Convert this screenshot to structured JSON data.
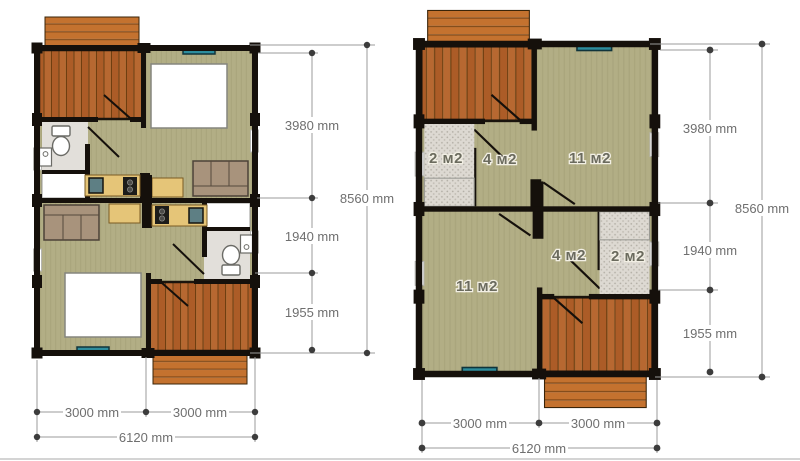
{
  "page": {
    "background": "#ffffff",
    "description": "Two duplex cabin floor plans with dimensions: left furnished, right with room areas"
  },
  "colors": {
    "wall": "#15100b",
    "deck_plank": "#ac5c27",
    "deck_plank_alt": "#b76831",
    "deck_gap": "#6f3e10",
    "stairs_plank": "#c4722f",
    "stairs_gap": "#7f4715",
    "floor_olive": "#b2ae85",
    "floor_grain": "#a8a47b",
    "window_teal": "#2d8d9d",
    "bath_floor": "#e2dfda",
    "bath_stipple": "#ddd9d2",
    "counter_tan": "#e5c578",
    "sofa": "#a8937c",
    "bed": "#ffffff",
    "dim_line": "#9b9b9b",
    "dim_dot": "#3c3c3c",
    "dim_text": "#6f6f6f",
    "room_label": "#6b6b5e"
  },
  "left_plan": {
    "dim_3980": "3980 mm",
    "dim_1940": "1940 mm",
    "dim_1955": "1955 mm",
    "dim_8560": "8560 mm",
    "dim_3000_left": "3000 mm",
    "dim_3000_right": "3000 mm",
    "dim_6120": "6120 mm"
  },
  "right_plan": {
    "dim_3980": "3980 mm",
    "dim_1940": "1940 mm",
    "dim_1955": "1955 mm",
    "dim_8560": "8560 mm",
    "dim_3000_left": "3000 mm",
    "dim_3000_right": "3000 mm",
    "dim_6120": "6120 mm",
    "rooms": {
      "top_bath": "2 м2",
      "top_hall": "4 м2",
      "top_room": "11 м2",
      "bottom_room": "11 м2",
      "bottom_hall": "4 м2",
      "bottom_bath": "2 м2"
    }
  }
}
